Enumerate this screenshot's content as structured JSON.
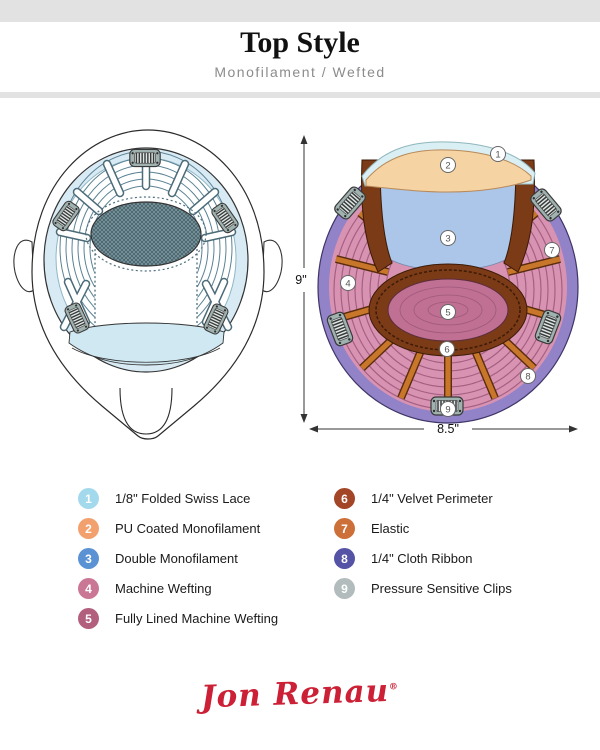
{
  "header": {
    "title": "Top Style",
    "subtitle": "Monofilament / Wefted"
  },
  "diagram": {
    "dim_height": "9\"",
    "dim_width": "8.5\""
  },
  "legend": {
    "items": [
      {
        "num": "1",
        "label": "1/8\" Folded Swiss Lace",
        "color": "#a3d9ec"
      },
      {
        "num": "2",
        "label": "PU Coated Monofilament",
        "color": "#f2a06e"
      },
      {
        "num": "3",
        "label": "Double Monofilament",
        "color": "#5b92d4"
      },
      {
        "num": "4",
        "label": "Machine Wefting",
        "color": "#c97795"
      },
      {
        "num": "5",
        "label": "Fully Lined Machine Wefting",
        "color": "#b25f7e"
      },
      {
        "num": "6",
        "label": "1/4\" Velvet Perimeter",
        "color": "#a34527"
      },
      {
        "num": "7",
        "label": "Elastic",
        "color": "#cc6f38"
      },
      {
        "num": "8",
        "label": "1/4\" Cloth Ribbon",
        "color": "#5553a5"
      },
      {
        "num": "9",
        "label": "Pressure Sensitive Clips",
        "color": "#b3bcbc"
      }
    ]
  },
  "footer": {
    "brand": "Jon Renau",
    "registered": "®"
  },
  "colors": {
    "brand_red": "#cc2036",
    "bar_gray": "#e2e2e2"
  }
}
